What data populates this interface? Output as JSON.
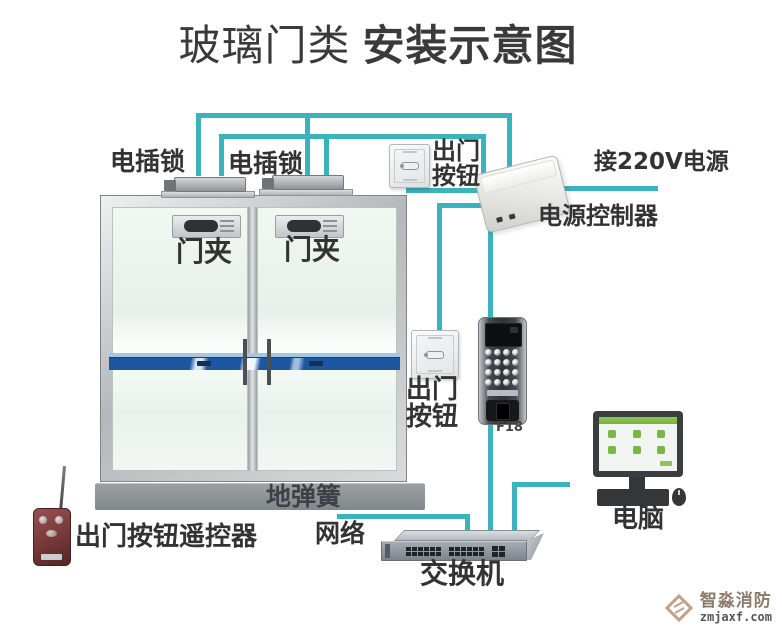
{
  "title": {
    "prefix": "玻璃门类",
    "emphasis": "安装示意图"
  },
  "diagram": {
    "locks": {
      "label_left": "电插锁",
      "label_right": "电插锁"
    },
    "clamps": {
      "label_left": "门夹",
      "label_right": "门夹"
    },
    "exit_button_top": {
      "line1": "出门",
      "line2": "按钮"
    },
    "exit_button_mid": {
      "line1": "出门",
      "line2": "按钮"
    },
    "power": {
      "mains_label": "接220V电源",
      "controller_label": "电源控制器"
    },
    "access_control": {
      "model_label": "F18"
    },
    "door": {
      "floor_spring_label": "地弹簧"
    },
    "remote": {
      "label": "出门按钮遥控器"
    },
    "network": {
      "label": "网络",
      "switch_label": "交换机",
      "computer_label": "电脑"
    }
  },
  "watermark": {
    "brand": "智淼消防",
    "domain": "zmjaxf.com"
  },
  "colors": {
    "wire": "#3ab3bd",
    "band_blue": "#1c55a0",
    "title_text": "#3a3a3a",
    "label_text": "#333333",
    "floor_spring": "#8d9296",
    "remote_red": "#713636",
    "device_dark": "#33373b",
    "screen_green": "#8fc353",
    "watermark_tan": "#bfa286"
  }
}
